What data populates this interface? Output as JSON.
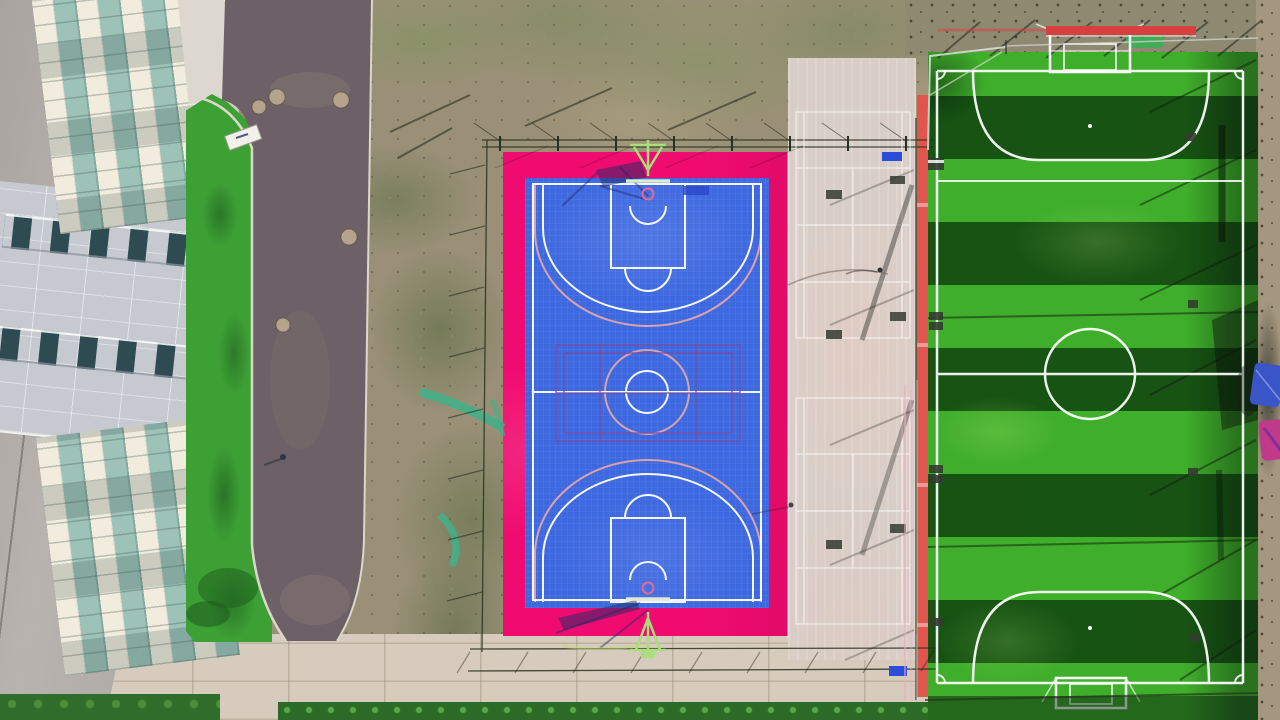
{
  "scene": {
    "description": "Aerial top-down drone photograph of a school sports complex: office building with glass curtain facade at left, curving asphalt access road, scrub dirt ground, fenced basketball court with magenta apron and royal-blue surface, light concrete multi-use court with badminton markings, red running strip, and a striped artificial-turf soccer pitch with white markings and goals at right.",
    "regions": [
      {
        "label": "building-facade"
      },
      {
        "label": "access-road"
      },
      {
        "label": "grass-verge"
      },
      {
        "label": "scrub-ground"
      },
      {
        "label": "basketball-court"
      },
      {
        "label": "multi-use-concrete-court"
      },
      {
        "label": "running-strip"
      },
      {
        "label": "soccer-field"
      },
      {
        "label": "pavement-walkway"
      },
      {
        "label": "hedges-and-grass"
      }
    ],
    "objects": [
      {
        "label": "basketball-hoop-north"
      },
      {
        "label": "basketball-hoop-south"
      },
      {
        "label": "soccer-goal-north"
      },
      {
        "label": "soccer-goal-south"
      },
      {
        "label": "center-circle"
      },
      {
        "label": "penalty-arcs"
      },
      {
        "label": "perimeter-fences"
      },
      {
        "label": "benches"
      },
      {
        "label": "pedestrians"
      },
      {
        "label": "manhole-covers"
      },
      {
        "label": "umbrella-canopies"
      },
      {
        "label": "red-barrier-bar"
      },
      {
        "label": "entrance-canopy"
      },
      {
        "label": "green-mesh-net"
      }
    ]
  },
  "colors": {
    "dirt_base": "#9a9077",
    "dirt_right": "#a5977f",
    "asphalt": "#6d6066",
    "curb": "#ddd6ca",
    "concrete_wall": "#b2adaa",
    "facade_cream": "#f2ecdf",
    "glass_teal": "#9dc2b8",
    "panel_band": "#c6c9d0",
    "window_glass": "#2d4b50",
    "verge_green": "#3da035",
    "pavement": "#d6cbbc",
    "hedge_green": "#2f6d2b",
    "grass_strip": "#2c6a27",
    "court_pink": "#f00b70",
    "court_blue": "#3e68df",
    "court_line": "#ffffff",
    "salmon_line": "#eaa9a4",
    "purple_line": "#7c4ea0",
    "hoop_green": "#aade7c",
    "rim_pink": "#e06a96",
    "shadow_navy": "#1c2a66",
    "gray_court": "#d9cec7",
    "red_stripe": "#e0564e",
    "red_bar": "#d84040",
    "field_green": "#3fae2b",
    "field_dark": "#1e5c1d",
    "fence_dark": "#26321f",
    "umbrella_blue": "#3a55c8",
    "umbrella_pink": "#c03a8c",
    "mesh_teal": "#3fb289",
    "bench_blue": "#2b4ed8"
  }
}
